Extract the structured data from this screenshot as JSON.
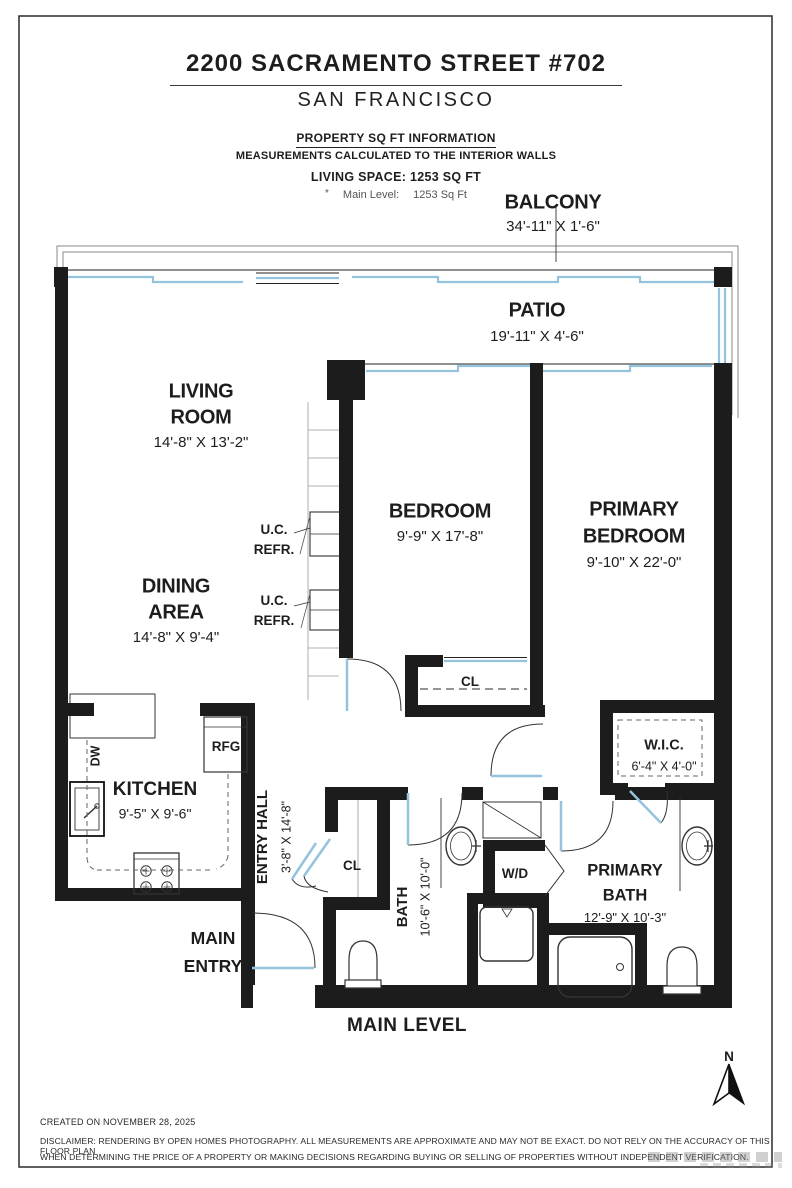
{
  "header": {
    "title": "2200 SACRAMENTO STREET #702",
    "city": "SAN FRANCISCO",
    "sqft_section_title": "PROPERTY SQ FT INFORMATION",
    "measurement_note": "MEASUREMENTS CALCULATED TO THE INTERIOR WALLS",
    "living_space": "LIVING SPACE: 1253 SQ FT",
    "level_bullet": "*",
    "level_label": "Main Level:",
    "level_value": "1253 Sq Ft"
  },
  "rooms": {
    "balcony": {
      "name": "BALCONY",
      "dims": "34'-11\" X 1'-6\""
    },
    "patio": {
      "name": "PATIO",
      "dims": "19'-11\" X 4'-6\""
    },
    "living_room": {
      "name_line1": "LIVING",
      "name_line2": "ROOM",
      "dims": "14'-8\" X 13'-2\""
    },
    "dining_area": {
      "name_line1": "DINING",
      "name_line2": "AREA",
      "dims": "14'-8\" X 9'-4\""
    },
    "bedroom": {
      "name": "BEDROOM",
      "dims": "9'-9\" X 17'-8\""
    },
    "primary_bedroom": {
      "name_line1": "PRIMARY",
      "name_line2": "BEDROOM",
      "dims": "9'-10\" X 22'-0\""
    },
    "kitchen": {
      "name": "KITCHEN",
      "dims": "9'-5\" X 9'-6\""
    },
    "entry_hall": {
      "name": "ENTRY HALL",
      "dims": "3'-8\" X 14'-8\""
    },
    "bath": {
      "name": "BATH",
      "dims": "10'-6\" X 10'-0\""
    },
    "primary_bath": {
      "name_line1": "PRIMARY",
      "name_line2": "BATH",
      "dims": "12'-9\" X 10'-3\""
    },
    "wic": {
      "name": "W.I.C.",
      "dims": "6'-4\" X 4'-0\""
    },
    "main_entry": {
      "name_line1": "MAIN",
      "name_line2": "ENTRY"
    }
  },
  "fixtures": {
    "dw": "DW",
    "rfg": "RFG",
    "wd": "W/D",
    "uc_refr_line1": "U.C.",
    "uc_refr_line2": "REFR.",
    "closet": "CL"
  },
  "plan": {
    "level_title": "MAIN LEVEL",
    "compass_north": "N"
  },
  "footer": {
    "created": "CREATED ON NOVEMBER 28, 2025",
    "disclaimer_line1": "DISCLAIMER: RENDERING BY OPEN HOMES PHOTOGRAPHY. ALL MEASUREMENTS ARE APPROXIMATE AND MAY NOT BE EXACT. DO NOT RELY ON THE ACCURACY OF THIS FLOOR PLAN",
    "disclaimer_line2": "WHEN DETERMINING THE PRICE OF A PROPERTY OR MAKING DECISIONS REGARDING BUYING OR SELLING OF PROPERTIES WITHOUT INDEPENDENT VERIFICATION."
  },
  "colors": {
    "wall": "#1c1c1c",
    "window": "#94c4dd",
    "railing": "#888"
  }
}
